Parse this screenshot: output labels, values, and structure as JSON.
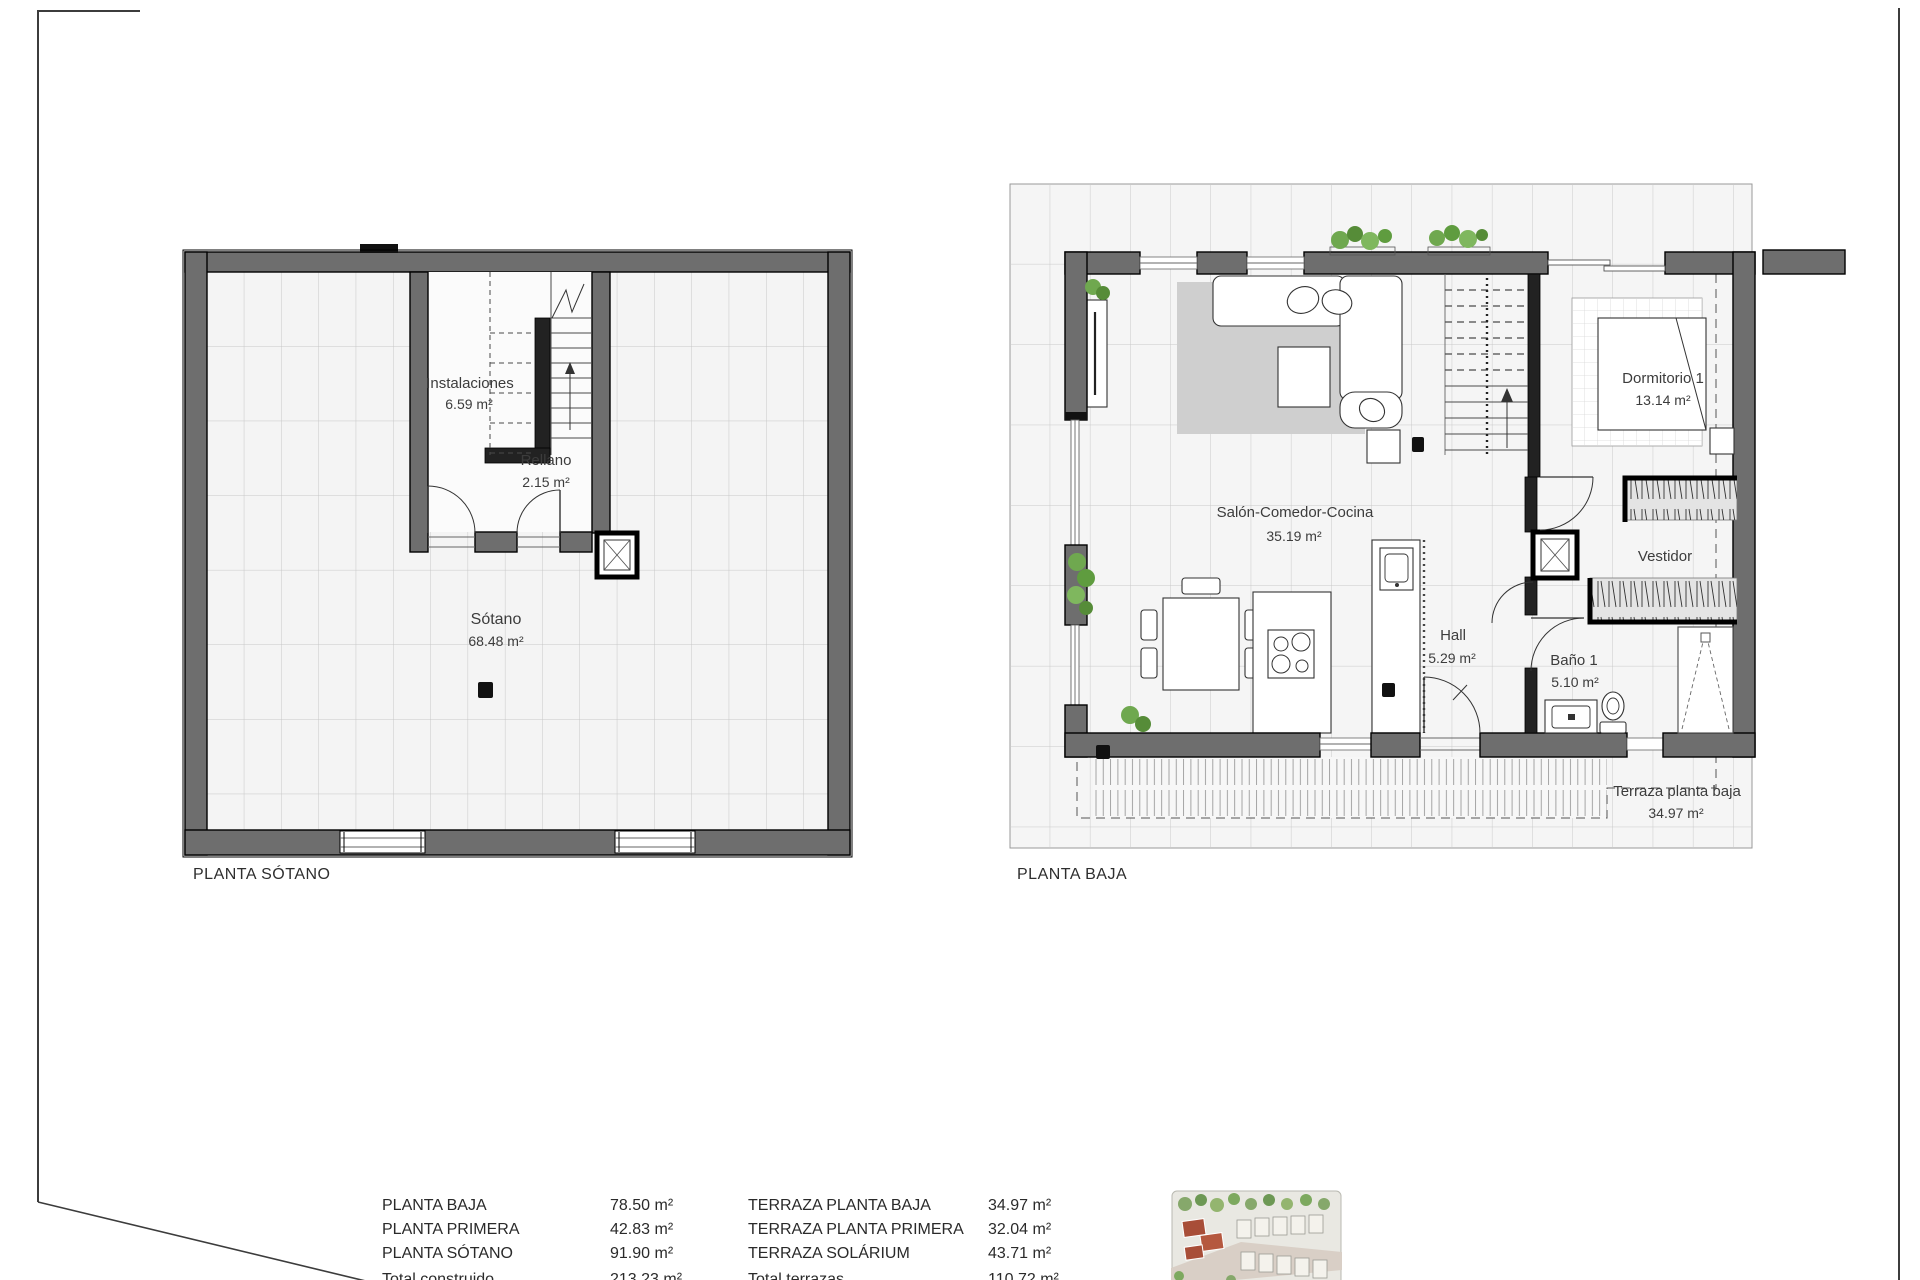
{
  "sheet": {
    "type": "architectural-floor-plan-sheet",
    "background": "#ffffff"
  },
  "plans": {
    "sotano": {
      "title": "PLANTA SÓTANO",
      "rooms": [
        {
          "name": "Instalaciones",
          "area": "6.59 m²"
        },
        {
          "name": "Rellano",
          "area": "2.15 m²"
        },
        {
          "name": "Sótano",
          "area": "68.48 m²"
        }
      ]
    },
    "baja": {
      "title": "PLANTA BAJA",
      "rooms": [
        {
          "name": "Salón-Comedor-Cocina",
          "area": "35.19 m²"
        },
        {
          "name": "Dormitorio 1",
          "area": "13.14 m²"
        },
        {
          "name": "Vestidor",
          "area": ""
        },
        {
          "name": "Hall",
          "area": "5.29 m²"
        },
        {
          "name": "Baño 1",
          "area": "5.10 m²"
        },
        {
          "name": "Terraza planta baja",
          "area": "34.97 m²"
        }
      ]
    }
  },
  "areas_table": {
    "col1": [
      {
        "label": "PLANTA BAJA",
        "value": "78.50 m²"
      },
      {
        "label": "PLANTA PRIMERA",
        "value": "42.83 m²"
      },
      {
        "label": "PLANTA SÓTANO",
        "value": "91.90 m²"
      },
      {
        "label": "Total construido",
        "value": "213.23 m²"
      }
    ],
    "col2": [
      {
        "label": "TERRAZA PLANTA BAJA",
        "value": "34.97 m²"
      },
      {
        "label": "TERRAZA PLANTA PRIMERA",
        "value": "32.04 m²"
      },
      {
        "label": "TERRAZA SOLÁRIUM",
        "value": "43.71 m²"
      },
      {
        "label": "Total terrazas",
        "value": "110.72 m²"
      }
    ]
  },
  "icons": {
    "elevator": "elevator-x-shaft",
    "stairs_up": "stair-direction-arrow"
  },
  "colors": {
    "wall": "#6e6e6e",
    "wall_edge": "#000000",
    "floor": "#f4f4f4",
    "grid": "#c9c9c9",
    "rug": "#cfcfcf",
    "plant_green": "#5f9c3f",
    "site_red": "#a84e38",
    "deck_line": "#9a9a9a"
  }
}
